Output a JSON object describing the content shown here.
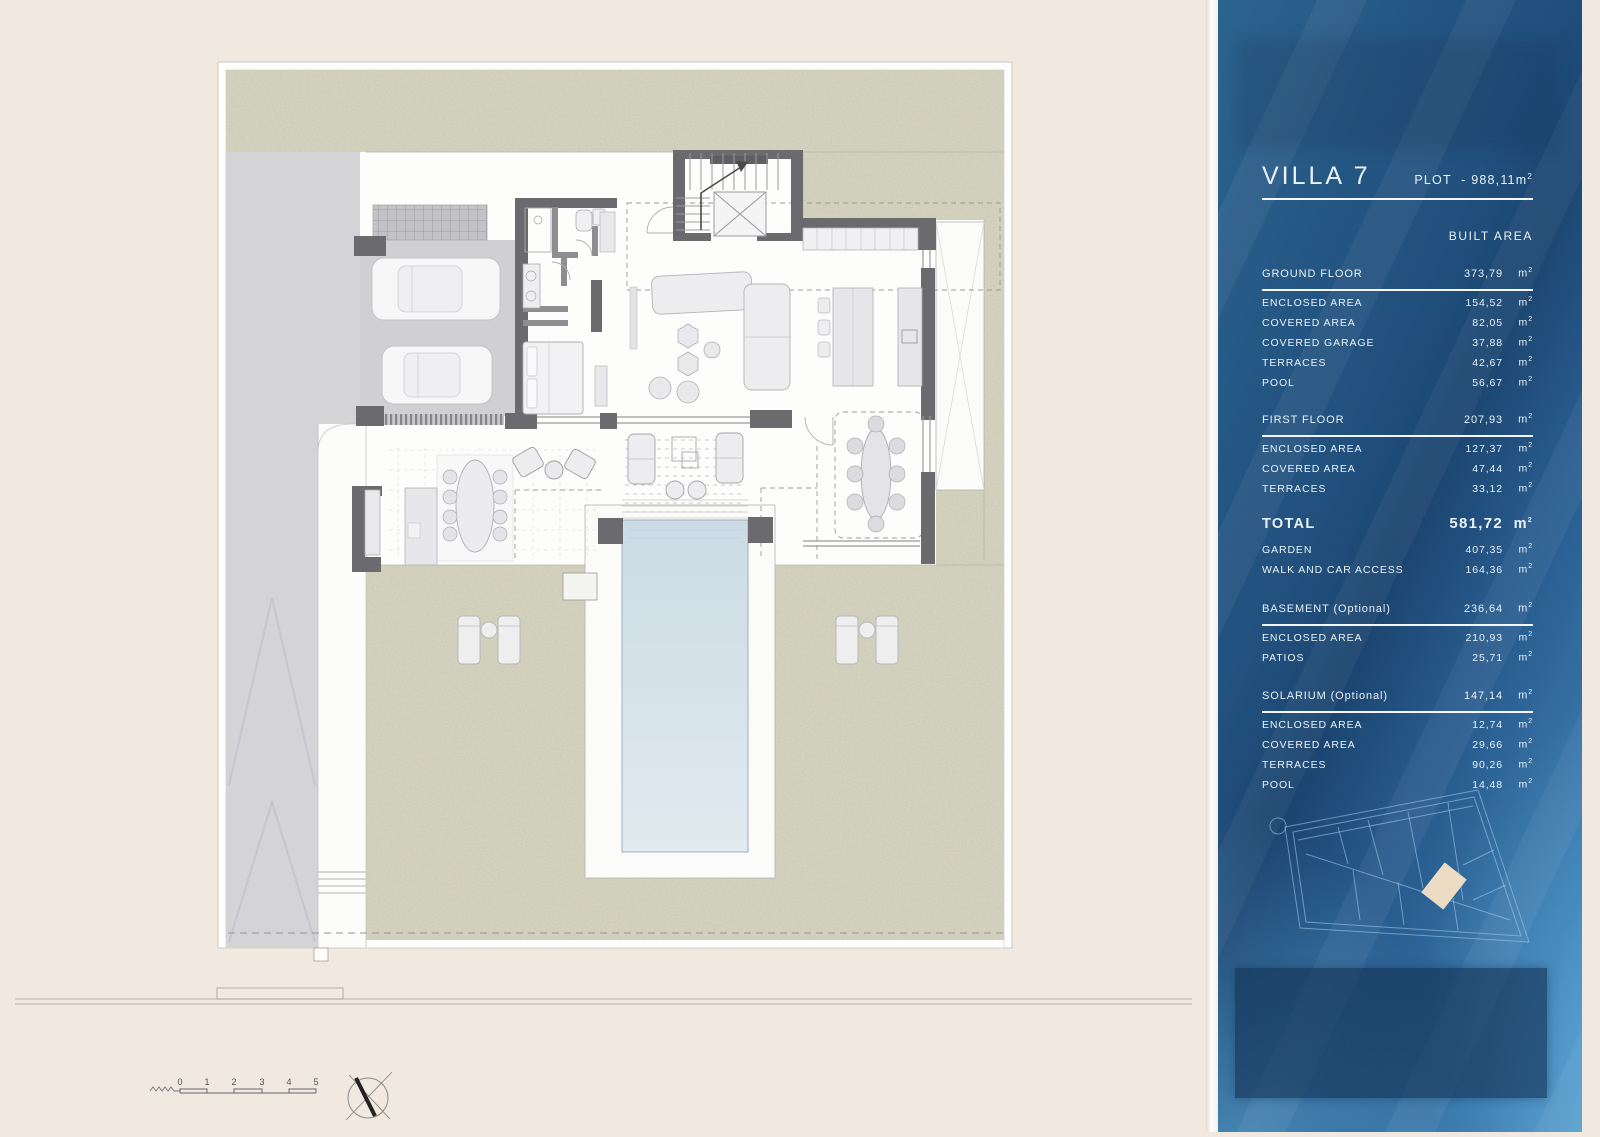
{
  "sidebar": {
    "title": "VILLA 7",
    "plot": {
      "label": "PLOT",
      "value": "- 988,11",
      "unit": "m",
      "sup": "2"
    },
    "built_area_label": "BUILT AREA",
    "unit": {
      "base": "m",
      "sup": "2"
    },
    "rows": [
      {
        "style": "header",
        "label": "GROUND FLOOR",
        "value": "373,79"
      },
      {
        "style": "row",
        "label": "ENCLOSED AREA",
        "value": "154,52"
      },
      {
        "style": "row",
        "label": "COVERED AREA",
        "value": "82,05"
      },
      {
        "style": "row",
        "label": "COVERED GARAGE",
        "value": "37,88"
      },
      {
        "style": "row",
        "label": "TERRACES",
        "value": "42,67"
      },
      {
        "style": "row",
        "label": "POOL",
        "value": "56,67"
      },
      {
        "style": "spacer",
        "size": 17
      },
      {
        "style": "header",
        "label": "FIRST FLOOR",
        "value": "207,93"
      },
      {
        "style": "row",
        "label": "ENCLOSED AREA",
        "value": "127,37"
      },
      {
        "style": "row",
        "label": "COVERED AREA",
        "value": "47,44"
      },
      {
        "style": "row",
        "label": "TERRACES",
        "value": "33,12"
      },
      {
        "style": "spacer",
        "size": 13
      },
      {
        "style": "total",
        "label": "TOTAL",
        "value": "581,72"
      },
      {
        "style": "row",
        "label": "GARDEN",
        "value": "407,35"
      },
      {
        "style": "row",
        "label": "WALK AND CAR ACCESS",
        "value": "164,36"
      },
      {
        "style": "spacer",
        "size": 19
      },
      {
        "style": "header",
        "label": "BASEMENT (Optional)",
        "value": "236,64"
      },
      {
        "style": "row",
        "label": "ENCLOSED AREA",
        "value": "210,93"
      },
      {
        "style": "row",
        "label": "PATIOS",
        "value": "25,71"
      },
      {
        "style": "spacer",
        "size": 18
      },
      {
        "style": "header",
        "label": "SOLARIUM (Optional)",
        "value": "147,14"
      },
      {
        "style": "row",
        "label": "ENCLOSED AREA",
        "value": "12,74"
      },
      {
        "style": "row",
        "label": "COVERED AREA",
        "value": "29,66"
      },
      {
        "style": "row",
        "label": "TERRACES",
        "value": "90,26"
      },
      {
        "style": "row",
        "label": "POOL",
        "value": "14,48"
      }
    ]
  },
  "plan": {
    "scale_labels": [
      "0",
      "1",
      "2",
      "3",
      "4",
      "5"
    ]
  },
  "colors": {
    "panel_blue": "#24557f",
    "garden_green": "#d7d6c2",
    "pool_blue": "#d3e1e9",
    "wall_gray": "#6a6a6f",
    "plot_highlight": "#ecdcc3"
  }
}
